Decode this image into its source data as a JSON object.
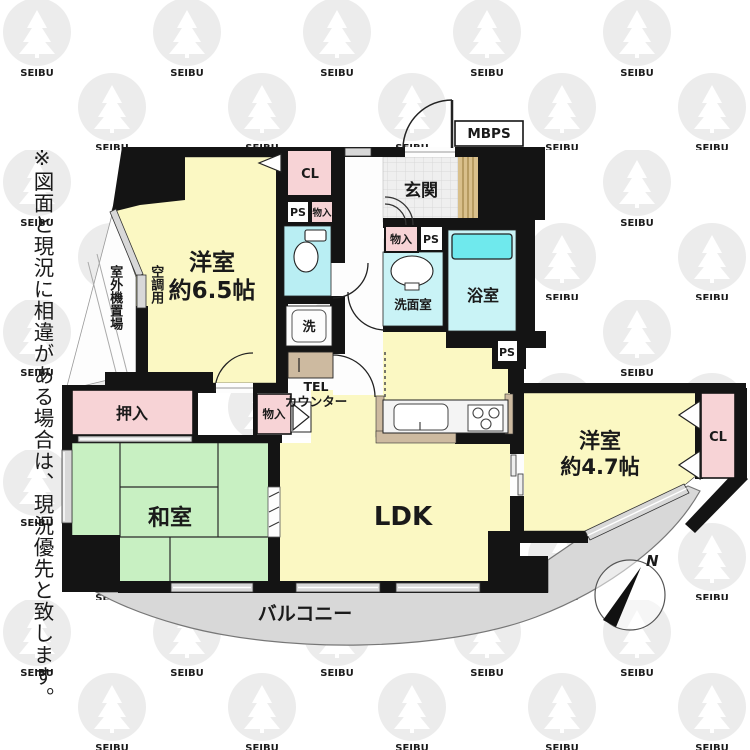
{
  "watermark": {
    "brand": "SEIBU"
  },
  "disclaimer": "※図面と現況に相違がある場合は、現況優先と致します。",
  "labels": {
    "room65_name": "洋室",
    "room65_size": "約6.5帖",
    "room47_name": "洋室",
    "room47_size": "約4.7帖",
    "washitsu": "和室",
    "ldk": "LDK",
    "genkan": "玄関",
    "bath": "浴室",
    "senmen": "洗面室",
    "oshiire": "押入",
    "monoire": "物入",
    "cl": "CL",
    "ps": "PS",
    "mbps": "MBPS",
    "laundry": "洗",
    "tel_line1": "TEL",
    "tel_line2": "カウンター",
    "balcony": "バルコニー",
    "ac_line1": "空調用",
    "ac_line2": "室外機置場",
    "north": "N"
  },
  "colors": {
    "wall": "#141414",
    "western_room": "#fbf8c3",
    "tatami_green": "#c8f0c2",
    "closet_pink": "#f7d3d6",
    "wet_cyan": "#c9f3f6",
    "toilet_cyan": "#b9eef3",
    "bathtub_cyan": "#6fe9ed",
    "balcony_gray": "#d8d8d8",
    "counter_tan": "#cdbaa0",
    "meter_tan": "#d9c08c",
    "tile_gray": "#efefef"
  }
}
